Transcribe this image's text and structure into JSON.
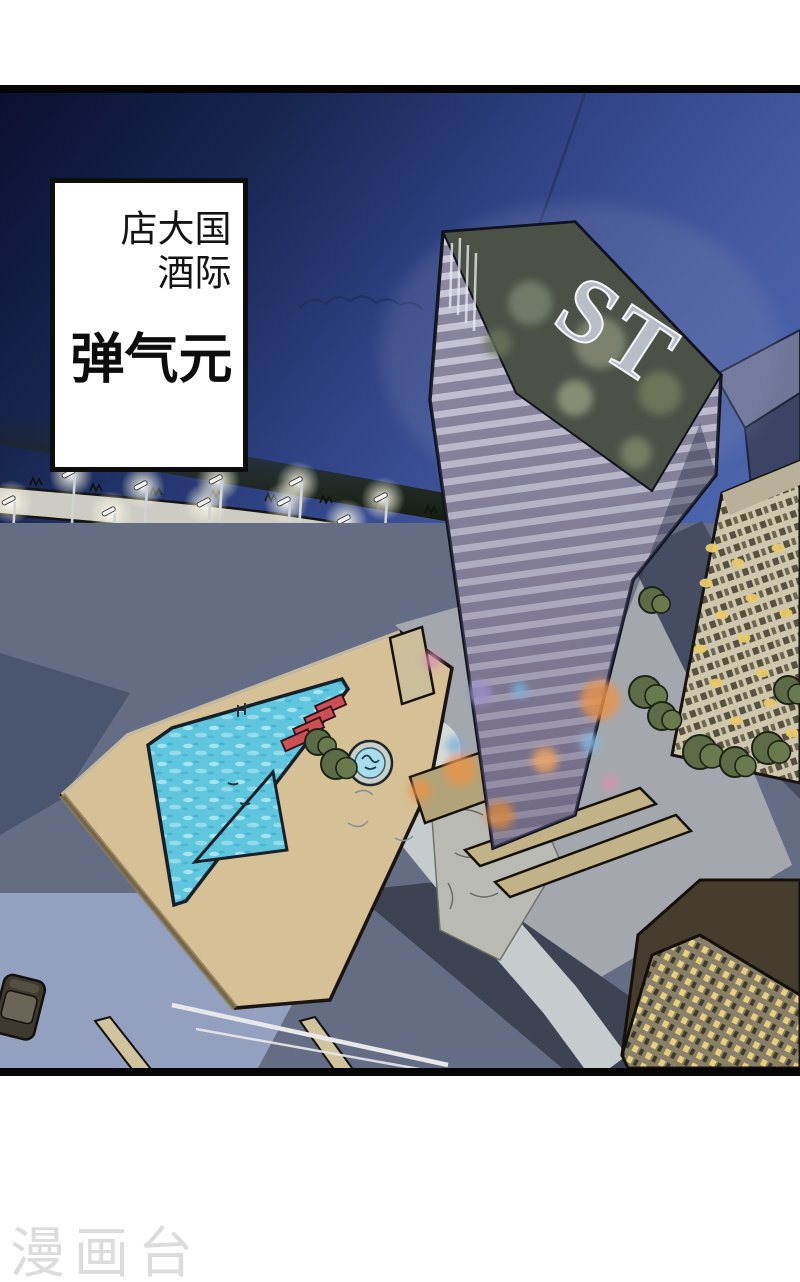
{
  "caption_box": {
    "location_line": "国际大酒店",
    "title_line": "元气弹"
  },
  "tower": {
    "sign_text": "ST"
  },
  "watermark": {
    "text": "漫画台"
  },
  "colors": {
    "page_background": "#ffffff",
    "panel_border": "#050505",
    "sky_dark": "#0a1030",
    "sky_light": "#4a63ab",
    "pool_water": "#5fc6de",
    "deck_tan": "#d6c096",
    "lounger_red": "#cc4f55",
    "trees_dark": "#3a453c",
    "trees_lit": "#93a159",
    "window_glow": "#e8c96a",
    "watermark_grey": "#dcdcdc"
  },
  "scene_objects": [
    "night-sky",
    "hotel-tower-with-ST-sign",
    "rooftop-reflections",
    "caption-box",
    "street-lamps-row",
    "tree-band",
    "swimming-pool",
    "small-pool",
    "red-loungers",
    "round-fountain",
    "pool-deck",
    "apartment-building-lit",
    "dark-highrise",
    "bottom-right-building",
    "parked-car",
    "roads-and-paths",
    "watermark"
  ]
}
